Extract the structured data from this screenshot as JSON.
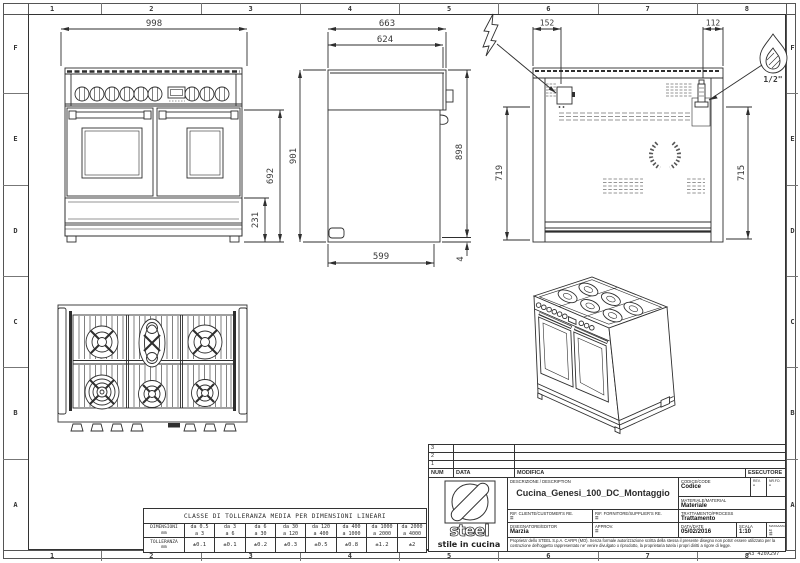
{
  "sheet": {
    "cols": [
      "1",
      "2",
      "3",
      "4",
      "5",
      "6",
      "7",
      "8"
    ],
    "rows": [
      "F",
      "E",
      "D",
      "C",
      "B",
      "A"
    ],
    "format": "A3 420X297",
    "ink_color": "#2e2e2e",
    "background": "#ffffff"
  },
  "dims": {
    "front": {
      "width": "998",
      "body_height": "692",
      "plinth_height": "231"
    },
    "side": {
      "depth_top": "663",
      "depth_mid": "624",
      "height_front": "901",
      "height_back": "898",
      "depth_base": "599",
      "foot": "4"
    },
    "back": {
      "elec_offset": "152",
      "gas_offset": "112",
      "elec_height": "719",
      "gas_height": "715",
      "gas_thread": "1/2\""
    }
  },
  "revisions": {
    "rows": [
      "3",
      "2",
      "1"
    ],
    "col_num": "NUM",
    "col_data": "DATA",
    "col_modifica": "MODIFICA",
    "col_esecutore": "ESECUTORE"
  },
  "title_block": {
    "description_label": "DESCRIZIONE / DESCRIPTION",
    "description": "Cucina_Genesi_100_DC_Montaggio",
    "code_label": "CODICE/CODE",
    "code": "Codice",
    "rev_label": "REV.",
    "rev": "-",
    "sheet_no_label": "NR.FO.",
    "sheet_no": "-",
    "material_label": "MATERIALE/MATERIAL",
    "material": "Materiale",
    "customer_ref_label": "RIF. CLIENTE/CUSTOMER'S RE.",
    "customer_ref": "=",
    "supplier_ref_label": "RIF. FORNITORE/SUPPLIER'S RE.",
    "supplier_ref": "=",
    "process_label": "TRATTAMENTO/PROCESS",
    "process": "Trattamento",
    "editor_label": "DISEGNATORE/EDITOR",
    "editor": "Marzia",
    "approval_label": "APPROV.",
    "approval": "=",
    "date_label": "DATA/DATE",
    "date": "05/02/2016",
    "scale_label": "SCALA",
    "scale": "1:10",
    "mass_label": "MASSA/MASS kg",
    "mass": "=",
    "legal": "Proprieta' dello STEEL S.p.A. CARPI (MO). Senza formale autorizzazione scritta della stessa il presente disegno non potra' essere utilizzato per la costruzione dell'oggetto rappresentato ne' venire divulgato o riprodotto, la proprietaria tutela i propri diritti a rigore di legge.",
    "logo_name": "steel",
    "logo_tagline": "stile in cucina"
  },
  "tolerance": {
    "title": "CLASSE DI TOLLERANZA MEDIA PER DIMENSIONI LINEARI",
    "dim_label": "DIMENSIONI",
    "tol_label": "TOLLERANZA",
    "unit": "mm",
    "range_top": [
      "da 0.5",
      "da 3",
      "da 6",
      "da 30",
      "da 120",
      "da 400",
      "da 1000",
      "da 2000"
    ],
    "range_bot": [
      "a 3",
      "a 6",
      "a 30",
      "a 120",
      "a 400",
      "a 1000",
      "a 2000",
      "a 4000"
    ],
    "values": [
      "±0.1",
      "±0.1",
      "±0.2",
      "±0.3",
      "±0.5",
      "±0.8",
      "±1.2",
      "±2"
    ]
  }
}
